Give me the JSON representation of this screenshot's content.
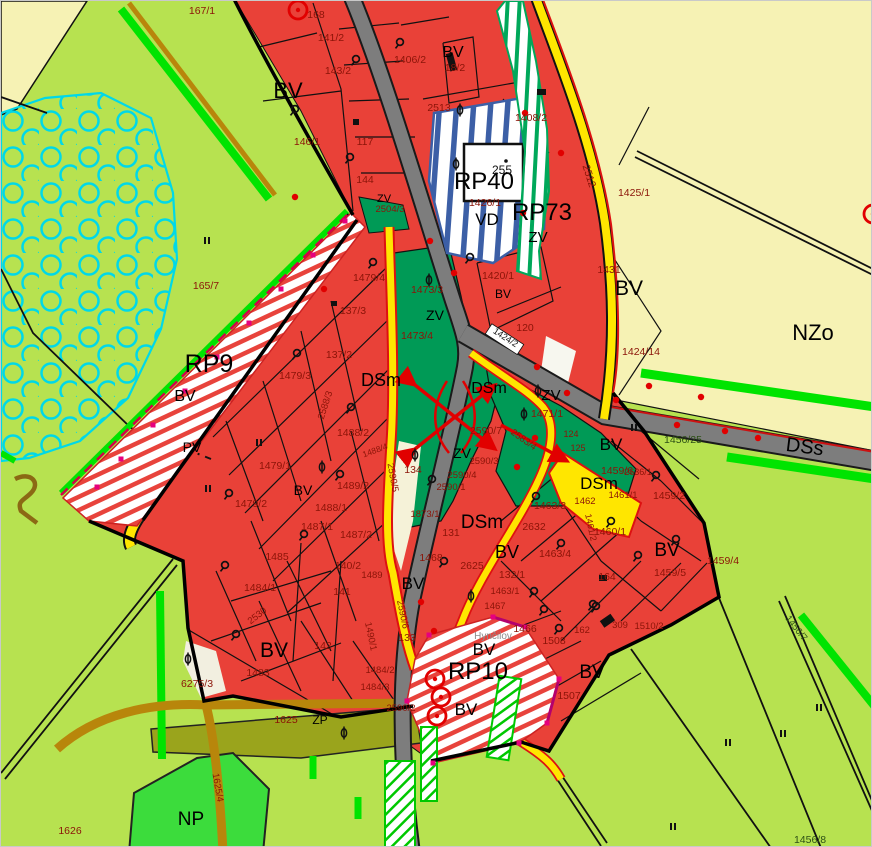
{
  "map": {
    "type": "municipal-zoning-plan",
    "colors": {
      "background": "#b7e250",
      "residential_red": "#e94138",
      "public_green_dark": "#009a56",
      "agriculture_cream": "#f6f2b4",
      "np_bright_green": "#3cdc3c",
      "zp_olive": "#9aa41c",
      "road_gray": "#7d7d7d",
      "road_yellow": "#ffe600",
      "road_khaki": "#b8860b",
      "hatch_blue": "#3c5fa6",
      "hatch_green": "#00a85a",
      "hatch_red": "#e8433c",
      "line_green": "#00e400",
      "line_cyan": "#00d8e8",
      "node_magenta": "#e6007e",
      "mark_red": "#e10000",
      "parcel_label": "#8b1408",
      "zone_label": "#000000"
    },
    "zone_labels": [
      {
        "t": "BV",
        "x": 452,
        "y": 56,
        "s": 16
      },
      {
        "t": "BV",
        "x": 287,
        "y": 97,
        "s": 22
      },
      {
        "t": "RP40",
        "x": 483,
        "y": 188,
        "s": 24
      },
      {
        "t": "VD",
        "x": 486,
        "y": 224,
        "s": 17
      },
      {
        "t": "RP73",
        "x": 541,
        "y": 219,
        "s": 24
      },
      {
        "t": "ZV",
        "x": 537,
        "y": 241,
        "s": 15
      },
      {
        "t": "ZV",
        "x": 383,
        "y": 201,
        "s": 11
      },
      {
        "t": "NZo",
        "x": 812,
        "y": 339,
        "s": 22
      },
      {
        "t": "BV",
        "x": 628,
        "y": 294,
        "s": 21
      },
      {
        "t": "BV",
        "x": 502,
        "y": 297,
        "s": 12
      },
      {
        "t": "ZV",
        "x": 434,
        "y": 319,
        "s": 14
      },
      {
        "t": "RP9",
        "x": 208,
        "y": 371,
        "s": 25
      },
      {
        "t": "BV",
        "x": 184,
        "y": 400,
        "s": 16
      },
      {
        "t": "PV",
        "x": 191,
        "y": 451,
        "s": 14
      },
      {
        "t": "DSm",
        "x": 380,
        "y": 385,
        "s": 18
      },
      {
        "t": "DSm",
        "x": 488,
        "y": 392,
        "s": 16
      },
      {
        "t": "ZV",
        "x": 550,
        "y": 399,
        "s": 15
      },
      {
        "t": "ZV",
        "x": 461,
        "y": 457,
        "s": 14
      },
      {
        "t": "DSs",
        "x": 803,
        "y": 452,
        "s": 20,
        "r": 7
      },
      {
        "t": "BV",
        "x": 610,
        "y": 449,
        "s": 17
      },
      {
        "t": "DSm",
        "x": 598,
        "y": 488,
        "s": 17
      },
      {
        "t": "BV",
        "x": 302,
        "y": 494,
        "s": 14
      },
      {
        "t": "BV",
        "x": 666,
        "y": 555,
        "s": 19
      },
      {
        "t": "DSm",
        "x": 481,
        "y": 527,
        "s": 19
      },
      {
        "t": "BV",
        "x": 506,
        "y": 557,
        "s": 18
      },
      {
        "t": "BV",
        "x": 412,
        "y": 588,
        "s": 17
      },
      {
        "t": "BV",
        "x": 273,
        "y": 656,
        "s": 21
      },
      {
        "t": "BV",
        "x": 483,
        "y": 654,
        "s": 17
      },
      {
        "t": "RP10",
        "x": 477,
        "y": 678,
        "s": 24
      },
      {
        "t": "BV",
        "x": 465,
        "y": 714,
        "s": 17
      },
      {
        "t": "BV",
        "x": 591,
        "y": 677,
        "s": 19
      },
      {
        "t": "NP",
        "x": 190,
        "y": 824,
        "s": 19
      },
      {
        "t": "ZP",
        "x": 319,
        "y": 723,
        "s": 12
      }
    ],
    "parcel_labels": [
      {
        "t": "167/1",
        "x": 201,
        "y": 13
      },
      {
        "t": "168",
        "x": 315,
        "y": 17
      },
      {
        "t": "141/2",
        "x": 330,
        "y": 40
      },
      {
        "t": "1406/2",
        "x": 409,
        "y": 62
      },
      {
        "t": "18/2",
        "x": 454,
        "y": 70
      },
      {
        "t": "143/2",
        "x": 337,
        "y": 73
      },
      {
        "t": "2513",
        "x": 438,
        "y": 110
      },
      {
        "t": "1408/2",
        "x": 530,
        "y": 120
      },
      {
        "t": "146/1",
        "x": 306,
        "y": 144
      },
      {
        "t": "117",
        "x": 364,
        "y": 144
      },
      {
        "t": "144",
        "x": 364,
        "y": 182
      },
      {
        "t": "2504/3",
        "x": 389,
        "y": 211,
        "s": 9.5
      },
      {
        "t": "255",
        "x": 501,
        "y": 173,
        "s": 12,
        "c": "#111111"
      },
      {
        "t": "1426/1",
        "x": 484,
        "y": 205
      },
      {
        "t": "2512",
        "x": 585,
        "y": 176,
        "r": 72
      },
      {
        "t": "1425/1",
        "x": 633,
        "y": 195
      },
      {
        "t": "1431",
        "x": 608,
        "y": 272
      },
      {
        "t": "1424/14",
        "x": 640,
        "y": 354
      },
      {
        "t": "1479/4",
        "x": 368,
        "y": 280
      },
      {
        "t": "1473/3",
        "x": 426,
        "y": 292
      },
      {
        "t": "1420/1",
        "x": 497,
        "y": 278
      },
      {
        "t": "120",
        "x": 524,
        "y": 330
      },
      {
        "t": "1473/4",
        "x": 416,
        "y": 338
      },
      {
        "t": "137/3",
        "x": 352,
        "y": 313
      },
      {
        "t": "137/2",
        "x": 338,
        "y": 357
      },
      {
        "t": "1479/3",
        "x": 294,
        "y": 378
      },
      {
        "t": "2588/3",
        "x": 327,
        "y": 405,
        "s": 9.5,
        "r": -72
      },
      {
        "t": "1488/2",
        "x": 352,
        "y": 435
      },
      {
        "t": "1488/4",
        "x": 375,
        "y": 452,
        "s": 8.5,
        "r": -20
      },
      {
        "t": "1471/1",
        "x": 546,
        "y": 416
      },
      {
        "t": "2590/7",
        "x": 485,
        "y": 433
      },
      {
        "t": "1424/2",
        "x": 503,
        "y": 339,
        "s": 9,
        "r": 33,
        "c": "#111111",
        "box": true
      },
      {
        "t": "165/7",
        "x": 205,
        "y": 288
      },
      {
        "t": "1479/1",
        "x": 274,
        "y": 468
      },
      {
        "t": "1479/2",
        "x": 250,
        "y": 506
      },
      {
        "t": "1489/2",
        "x": 352,
        "y": 488
      },
      {
        "t": "1488/1",
        "x": 330,
        "y": 510
      },
      {
        "t": "1487/1",
        "x": 316,
        "y": 529
      },
      {
        "t": "1487/2",
        "x": 355,
        "y": 537
      },
      {
        "t": "134",
        "x": 412,
        "y": 472
      },
      {
        "t": "2590/3",
        "x": 483,
        "y": 463,
        "s": 9.5
      },
      {
        "t": "2590/4",
        "x": 461,
        "y": 477,
        "s": 9.5
      },
      {
        "t": "2590/1",
        "x": 450,
        "y": 489,
        "s": 9.5
      },
      {
        "t": "2590/5",
        "x": 389,
        "y": 477,
        "s": 9.5,
        "r": 80
      },
      {
        "t": "2583/4",
        "x": 521,
        "y": 441,
        "s": 9.5,
        "r": 36
      },
      {
        "t": "1456/25",
        "x": 682,
        "y": 442,
        "c": "#2d5016"
      },
      {
        "t": "1459/6",
        "x": 616,
        "y": 473
      },
      {
        "t": "1461/1",
        "x": 622,
        "y": 497,
        "s": 9.5
      },
      {
        "t": "1462",
        "x": 584,
        "y": 503,
        "s": 9.5
      },
      {
        "t": "1461/2",
        "x": 587,
        "y": 527,
        "s": 9,
        "r": 78
      },
      {
        "t": "1460/1",
        "x": 609,
        "y": 534
      },
      {
        "t": "1459/2",
        "x": 668,
        "y": 498
      },
      {
        "t": "1459/4",
        "x": 722,
        "y": 563
      },
      {
        "t": "1459/5",
        "x": 669,
        "y": 575
      },
      {
        "t": "164",
        "x": 606,
        "y": 579
      },
      {
        "t": "124",
        "x": 570,
        "y": 436,
        "s": 9
      },
      {
        "t": "125",
        "x": 577,
        "y": 450,
        "s": 9
      },
      {
        "t": "2636/1",
        "x": 637,
        "y": 474,
        "s": 9
      },
      {
        "t": "1463/3",
        "x": 549,
        "y": 508
      },
      {
        "t": "2632",
        "x": 533,
        "y": 529
      },
      {
        "t": "1463/4",
        "x": 554,
        "y": 556
      },
      {
        "t": "132/1",
        "x": 511,
        "y": 577
      },
      {
        "t": "2625",
        "x": 471,
        "y": 568
      },
      {
        "t": "1463/1",
        "x": 504,
        "y": 593,
        "s": 9.5
      },
      {
        "t": "1467",
        "x": 494,
        "y": 608,
        "s": 9.5
      },
      {
        "t": "1466",
        "x": 524,
        "y": 631
      },
      {
        "t": "1508",
        "x": 553,
        "y": 643
      },
      {
        "t": "162",
        "x": 581,
        "y": 632,
        "s": 9.5
      },
      {
        "t": "309",
        "x": 619,
        "y": 627,
        "s": 9.5
      },
      {
        "t": "1510/2",
        "x": 648,
        "y": 628,
        "s": 9.5
      },
      {
        "t": "1507",
        "x": 568,
        "y": 698
      },
      {
        "t": "1468",
        "x": 430,
        "y": 560
      },
      {
        "t": "131",
        "x": 450,
        "y": 535
      },
      {
        "t": "1873/1",
        "x": 424,
        "y": 516,
        "s": 9.5
      },
      {
        "t": "1485",
        "x": 276,
        "y": 559
      },
      {
        "t": "1484/1",
        "x": 259,
        "y": 590
      },
      {
        "t": "2530",
        "x": 258,
        "y": 617,
        "s": 9.5,
        "r": -38
      },
      {
        "t": "140/2",
        "x": 347,
        "y": 568
      },
      {
        "t": "1489",
        "x": 371,
        "y": 577,
        "s": 9.5
      },
      {
        "t": "141",
        "x": 341,
        "y": 594
      },
      {
        "t": "142",
        "x": 322,
        "y": 648
      },
      {
        "t": "1483",
        "x": 257,
        "y": 675
      },
      {
        "t": "6275/3",
        "x": 196,
        "y": 686
      },
      {
        "t": "1484/2",
        "x": 379,
        "y": 672,
        "s": 9.5
      },
      {
        "t": "1484/3",
        "x": 374,
        "y": 689,
        "s": 9.5
      },
      {
        "t": "2590/6",
        "x": 399,
        "y": 614,
        "s": 9.5,
        "r": 78
      },
      {
        "t": "1490/1",
        "x": 367,
        "y": 636,
        "s": 9.5,
        "r": 78
      },
      {
        "t": "2590/2",
        "x": 400,
        "y": 710,
        "s": 9.5
      },
      {
        "t": "133",
        "x": 406,
        "y": 640
      },
      {
        "t": "1625",
        "x": 285,
        "y": 722
      },
      {
        "t": "1626",
        "x": 69,
        "y": 833
      },
      {
        "t": "1625/4",
        "x": 214,
        "y": 787,
        "s": 9.5,
        "r": 80
      },
      {
        "t": "1456/7",
        "x": 793,
        "y": 629,
        "s": 9.5,
        "r": 52,
        "c": "#2d5016"
      },
      {
        "t": "1456/8",
        "x": 809,
        "y": 842,
        "c": "#2d5016"
      }
    ],
    "place_labels": [
      {
        "t": "Hynčilov",
        "x": 492,
        "y": 638,
        "s": 10,
        "c": "#8c8c8c"
      }
    ],
    "symbols": {
      "deciduous_tree": [
        [
          399,
          41
        ],
        [
          355,
          58
        ],
        [
          294,
          108
        ],
        [
          349,
          156
        ],
        [
          372,
          261
        ],
        [
          469,
          256
        ],
        [
          296,
          352
        ],
        [
          350,
          406
        ],
        [
          431,
          478
        ],
        [
          303,
          533
        ],
        [
          228,
          492
        ],
        [
          224,
          564
        ],
        [
          235,
          633
        ],
        [
          535,
          495
        ],
        [
          560,
          542
        ],
        [
          533,
          590
        ],
        [
          543,
          608
        ],
        [
          558,
          627
        ],
        [
          595,
          605
        ],
        [
          610,
          520
        ],
        [
          655,
          474
        ],
        [
          675,
          538
        ],
        [
          637,
          554
        ],
        [
          592,
          603
        ],
        [
          443,
          560
        ],
        [
          339,
          473
        ]
      ],
      "conifer_tree": [
        [
          459,
          109
        ],
        [
          455,
          163
        ],
        [
          428,
          279
        ],
        [
          321,
          466
        ],
        [
          470,
          595
        ],
        [
          343,
          732
        ],
        [
          187,
          658
        ],
        [
          414,
          454
        ],
        [
          537,
          390
        ],
        [
          523,
          413
        ]
      ],
      "red_dot": [
        [
          294,
          196
        ],
        [
          323,
          288
        ],
        [
          429,
          240
        ],
        [
          453,
          272
        ],
        [
          522,
          212
        ],
        [
          560,
          152
        ],
        [
          524,
          112
        ],
        [
          536,
          366
        ],
        [
          566,
          392
        ],
        [
          615,
          399
        ],
        [
          648,
          385
        ],
        [
          700,
          396
        ],
        [
          724,
          430
        ],
        [
          757,
          437
        ],
        [
          676,
          424
        ],
        [
          420,
          601
        ],
        [
          433,
          630
        ],
        [
          516,
          466
        ],
        [
          534,
          437
        ]
      ],
      "magenta_node": [
        [
          344,
          220
        ],
        [
          312,
          254
        ],
        [
          280,
          288
        ],
        [
          248,
          322
        ],
        [
          216,
          356
        ],
        [
          184,
          390
        ],
        [
          152,
          424
        ],
        [
          120,
          458
        ],
        [
          96,
          486
        ],
        [
          428,
          634
        ],
        [
          492,
          616
        ],
        [
          524,
          626
        ],
        [
          558,
          678
        ],
        [
          546,
          722
        ],
        [
          518,
          742
        ],
        [
          432,
          762
        ],
        [
          406,
          700
        ]
      ],
      "ditto_mark": [
        [
          206,
          240
        ],
        [
          207,
          488
        ],
        [
          258,
          442
        ],
        [
          633,
          427
        ],
        [
          672,
          826
        ],
        [
          727,
          742
        ],
        [
          782,
          733
        ],
        [
          818,
          707
        ]
      ],
      "red_circle_marker": [
        [
          297,
          9
        ],
        [
          872,
          213
        ],
        [
          434,
          678
        ],
        [
          440,
          696
        ],
        [
          436,
          715
        ]
      ]
    }
  }
}
